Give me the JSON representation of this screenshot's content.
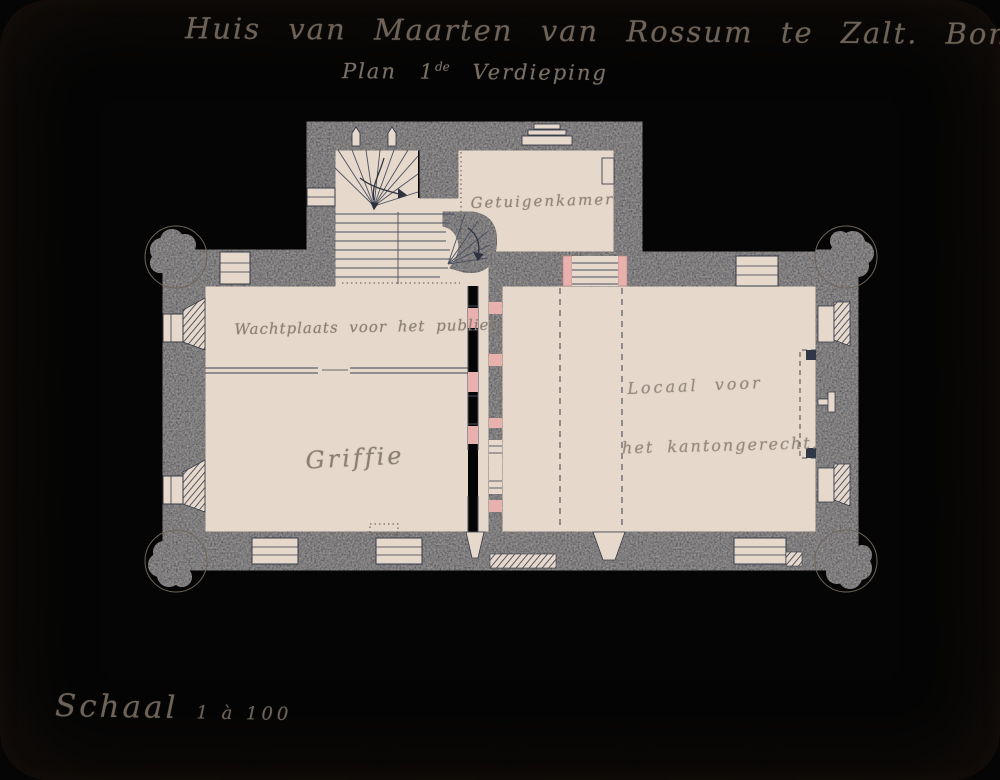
{
  "document": {
    "title": "Huis van Maarten van Rossum te Zalt. Bommel.",
    "subtitle": {
      "plan": "Plan",
      "ordinal": "1",
      "ordinal_suffix": "de",
      "floor": "Verdieping"
    },
    "scale": {
      "word": "Schaal",
      "value": "1 à 100"
    }
  },
  "rooms": {
    "witness_room": "Getuigenkamer.",
    "public_waiting": "Wachtplaats voor het publiek",
    "registry": "Griffie",
    "court_line1": "Locaal voor",
    "court_line2": "het kantongerecht."
  },
  "colors": {
    "paper": "#dac7b8",
    "wall_ink": "#303746",
    "accent_pink": "#e9b1ae",
    "pencil_text": "#85796f"
  }
}
